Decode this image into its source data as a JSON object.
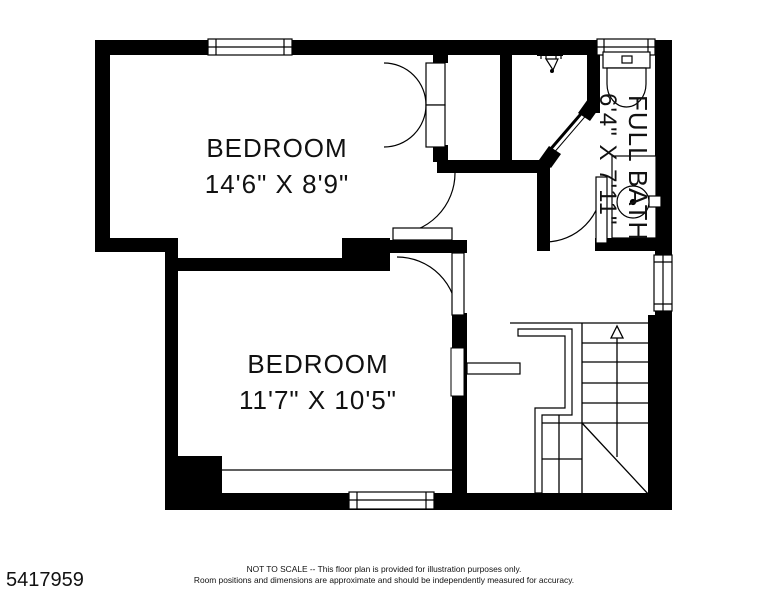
{
  "plan": {
    "rooms": [
      {
        "label": "BEDROOM",
        "dims": "14'6\" X 8'9\""
      },
      {
        "label": "BEDROOM",
        "dims": "11'7\" X 10'5\""
      },
      {
        "label": "FULL BATH",
        "dims": "6'4\" X 7'11\""
      }
    ],
    "colors": {
      "wall": "#000000",
      "text": "#111111",
      "background": "#ffffff"
    },
    "icons": [
      "window",
      "door-swing",
      "double-door",
      "shower-head",
      "shower-glass-door",
      "toilet",
      "sink-vanity",
      "stairs-up-arrow",
      "stair-railing"
    ]
  },
  "footer": {
    "listing_id": "5417959",
    "disclaimer_line1": "NOT TO SCALE -- This floor plan is provided for illustration purposes only.",
    "disclaimer_line2": "Room positions and dimensions are approximate and should be independently measured for accuracy."
  }
}
